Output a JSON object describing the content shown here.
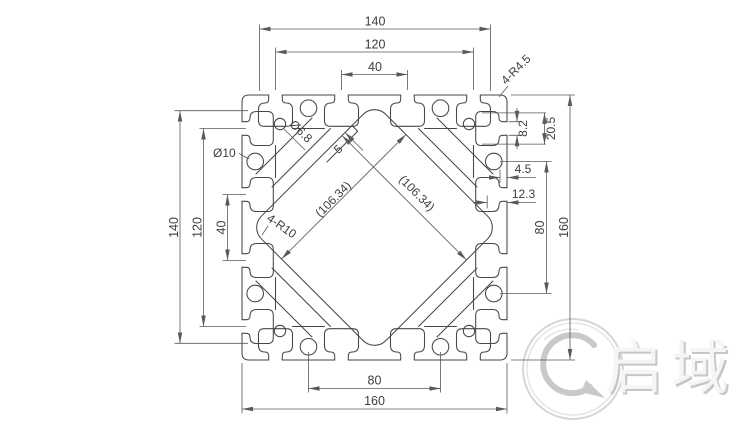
{
  "drawing": {
    "background": "#ffffff",
    "line_color": "#474747",
    "dim_color": "#5a5a5a",
    "dims": {
      "top": {
        "outer": "140",
        "middle": "120",
        "inner": "40"
      },
      "left": {
        "outer": "140",
        "middle": "120",
        "inner": "40"
      },
      "right": {
        "slot_opening": "8.2",
        "slot_depth": "20.5",
        "lip": "4.5",
        "web": "12.3",
        "holes": "80",
        "overall": "160"
      },
      "bottom": {
        "holes": "80",
        "overall": "160"
      }
    },
    "labels": {
      "corner_radius": "4-R4.5",
      "small_hole": "Ø6.8",
      "large_hole": "Ø10",
      "core_radius": "4-R10",
      "step": "5",
      "diagonal_left": "(106.34)",
      "diagonal_right": "(106.34)"
    },
    "logo": {
      "text": "启域",
      "color": "#cccccc"
    }
  }
}
